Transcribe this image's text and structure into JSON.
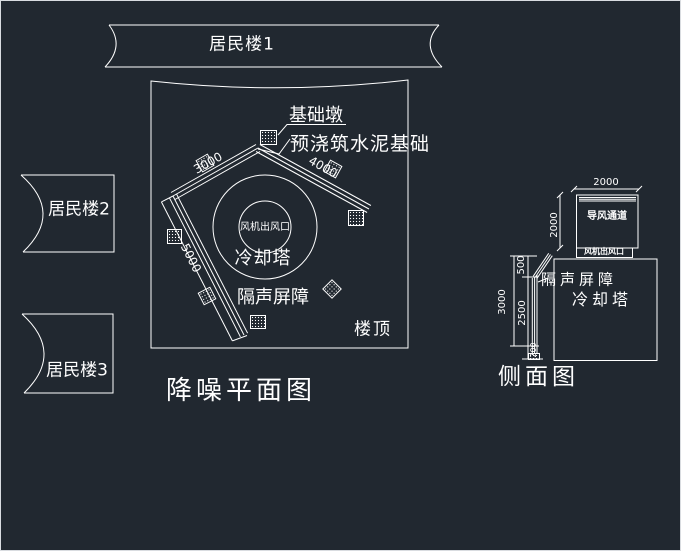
{
  "drawing": {
    "type": "cad-noise-reduction-plan",
    "colors": {
      "background": "#212830",
      "line": "#ffffff",
      "barrier_green": "#00cc00",
      "frame_border": "#d9dce0"
    }
  },
  "buildings": {
    "b1": "居民楼1",
    "b2": "居民楼2",
    "b3": "居民楼3"
  },
  "plan": {
    "title": "降噪平面图",
    "roof": "楼顶",
    "cooling_tower": "冷却塔",
    "fan_outlet": "风机出风口",
    "barrier": "隔声屏障",
    "pier": "基础墩",
    "foundation": "预浇筑水泥基础",
    "dims": {
      "upper_left": "3000",
      "right": "4000",
      "lower_left": "5000"
    }
  },
  "side": {
    "title": "侧面图",
    "duct": "导风通道",
    "fan_outlet": "风机出风口",
    "barrier": "隔声屏障",
    "cooling_tower": "冷却塔",
    "dims": {
      "duct_width": "2000",
      "duct_height": "2000",
      "barrier_top": "500",
      "barrier_mid": "2500",
      "total_height": "3000",
      "base": "200"
    }
  }
}
